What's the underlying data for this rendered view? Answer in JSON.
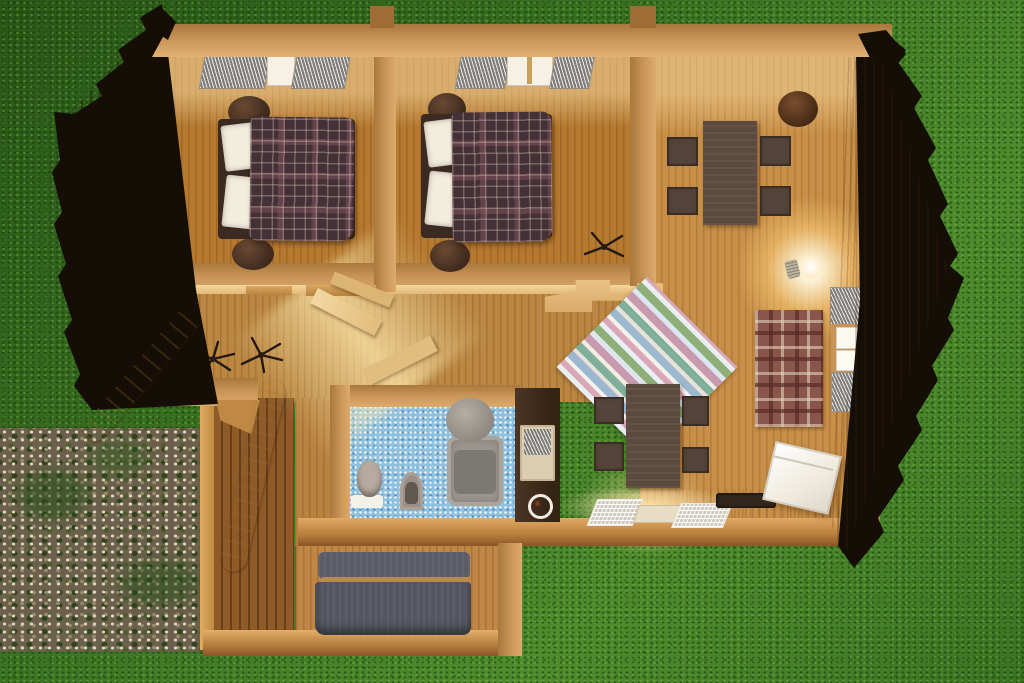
{
  "meta": {
    "description": "Top-down 3D architectural render of a single-storey wooden log cabin with the roof cut away, placed on a grass lawn with a gravel patch at the lower left"
  },
  "colors": {
    "grass": "#3c7323",
    "grass-dark": "#2a5517",
    "grass-light": "#4f8c2d",
    "roof-dark": "#8f4d16",
    "roof-light": "#cf9347",
    "shingle-black": "#150e07",
    "wall-tan": "#c89357",
    "wall-lit": "#f0cd92",
    "floor-wood": "#b5792f",
    "floor-hall": "#bb8742",
    "floor-right": "#c78f47",
    "bath-tile": "#8fc0de",
    "bed-plaid": "#443037",
    "pillow": "#f3edde",
    "table-brown": "#5d4a3e",
    "sofa-gray": "#565761",
    "rug-tartan": "#8a564c",
    "rug-pink": "#d9a8b8",
    "rug-blue": "#9cb8d0",
    "rug-green": "#7fae9a",
    "cube-white": "#f2efe7",
    "lamp-glow": "#ffe3a6",
    "cream-logs": "#f0d9a4",
    "gravel": "#6b604b",
    "cabinet-dark": "#412d1e"
  },
  "exterior": {
    "elements": [
      {
        "name": "grass-lawn"
      },
      {
        "name": "gravel-patch"
      },
      {
        "name": "left-roof-slope",
        "finish": "dark stained planks, black scalloped shingle edge"
      },
      {
        "name": "right-roof-slope",
        "finish": "light planks, black scalloped shingle edge"
      },
      {
        "name": "cut-log-wall-bands",
        "finish": "cream wavy cross-sections"
      }
    ]
  },
  "rooms": [
    {
      "name": "bedroom-1",
      "position": "top-left",
      "furniture": [
        "double-bed-plaid-blanket",
        "white-pillows",
        "round-nightstand-top",
        "round-nightstand-bottom",
        "ceiling-window-with-gray-shades"
      ]
    },
    {
      "name": "bedroom-2",
      "position": "top-middle",
      "furniture": [
        "double-bed-plaid-blanket",
        "white-pillows",
        "round-nightstand-top",
        "round-nightstand-bottom",
        "ceiling-window-with-gray-shades"
      ]
    },
    {
      "name": "hallway",
      "position": "middle-left",
      "furniture": [
        "ceiling-fan",
        "ceiling-fan",
        "open-door-panel",
        "stair-planks",
        "sunlight-beam"
      ]
    },
    {
      "name": "bathroom",
      "position": "center",
      "furniture": [
        "blue-mosaic-floor",
        "toilet",
        "white-bath-mat",
        "pedestal-sink",
        "bathtub-with-shower"
      ]
    },
    {
      "name": "kitchen-strip",
      "position": "bottom-center",
      "furniture": [
        "wood-counter",
        "dish-rack-left",
        "sink-tray",
        "dish-rack-right",
        "dark-cooktop",
        "tall-dark-cabinet-with-oven",
        "white-ring-hob"
      ]
    },
    {
      "name": "living-dining-room",
      "position": "right",
      "furniture": [
        "dining-table-upper",
        "four-dark-chairs-upper",
        "barrel-stool",
        "glowing-lamp",
        "tartan-rug",
        "pastel-striped-rug-diagonal",
        "dining-table-lower",
        "four-dark-chairs-lower",
        "wall-shelf-unit",
        "white-cube-armchair",
        "ceiling-fan"
      ]
    },
    {
      "name": "porch-room",
      "position": "bottom-left-extension",
      "furniture": [
        "gray-sofa"
      ]
    }
  ]
}
